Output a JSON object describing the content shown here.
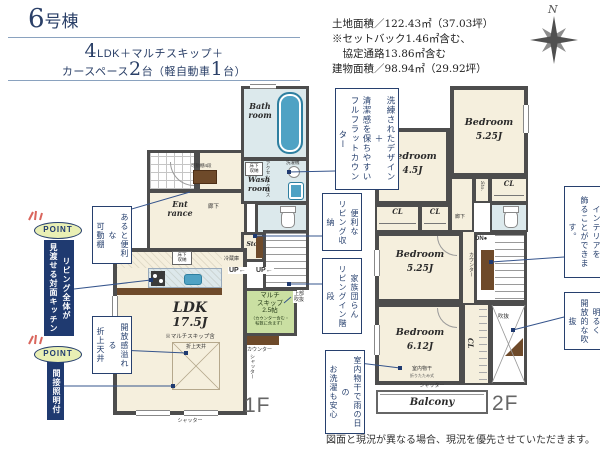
{
  "colors": {
    "navy": "#1f3a70",
    "annotation_navy": "#27406e",
    "leader_line": "#35548c",
    "room_cream": "#f5efdd",
    "water_blue": "#dce9ec",
    "fixture_teal": "#4fa2c4",
    "skip_green": "#cadfa2",
    "wood_brown": "#6e4a2a",
    "wall_gray": "#4d4d4d",
    "point_badge_bg": "#e9efb4",
    "tick_red": "#d9655c"
  },
  "header": {
    "building_num": "6",
    "building_name": "号棟",
    "spec_num1": "4",
    "spec_rest1": "LDK＋マルチスキップ＋",
    "spec_pre2": "カースペース",
    "spec_num2": "2",
    "spec_mid2": "台（軽自動車",
    "spec_num3": "1",
    "spec_end2": "台）"
  },
  "site_info": {
    "lines": [
      "土地面積／122.43㎡（37.03坪）",
      "※セットバック1.46㎡含む、",
      "　協定通路13.86㎡含む",
      "建物面積／98.94㎡（29.92坪）"
    ]
  },
  "compass": {
    "label": "N"
  },
  "points": [
    {
      "badge": "POINT",
      "text": "リビング全体が\n見渡せる対面キッチン"
    },
    {
      "badge": "POINT",
      "text": "間接照明付き"
    }
  ],
  "annotations": [
    {
      "text": "あると便利な\n可動棚"
    },
    {
      "text": "開放感溢れる\n折上天井"
    },
    {
      "text": "洗練されたデザイン＋\n清潔感を保ちやすい\nフルフラットカウンター"
    },
    {
      "text": "便利な\nリビング収納"
    },
    {
      "text": "家族団らん\nリビングイン階段"
    },
    {
      "text": "室内物干で雨の日の\nお洗濯も安心"
    },
    {
      "text": "インテリアを\n飾ることができます。"
    },
    {
      "text": "明るく\n開放的な吹抜"
    }
  ],
  "floor1": {
    "label": "1F",
    "bath": "Bath\nroom",
    "wash": "Wash\nroom",
    "entrance": "Ent\nrance",
    "ldk_name": "LDK",
    "ldk_size": "17.5J",
    "ldk_note": "※マルチスキップ含",
    "oriage": "折上天井",
    "multiskip": "マルチ\nスキップ\n2.5帖",
    "multiskip_note": "（カウンター含む・\n帖数に含まず）",
    "joubu_fukinuke": "上部\n吹抜",
    "rouka": "廊下",
    "kadoudana": "可動棚4段",
    "reizouko": "冷蔵庫",
    "yukashita": "床下\n収納",
    "accent_cloth": "アクセントクロス",
    "sentakuki": "洗濯機",
    "sto": "Sto.",
    "up1": "UP←",
    "up2": "UP←",
    "counter": "カウンター",
    "shutter_side": "シャッター",
    "shutter_bottom": "シャッター"
  },
  "floor2": {
    "label": "2F",
    "bed1_name": "Bedroom",
    "bed1_size": "4.5J",
    "bed2_name": "Bedroom",
    "bed2_size": "5.25J",
    "bed3_name": "Bedroom",
    "bed3_size": "5.25J",
    "bed4_name": "Bedroom",
    "bed4_size": "6.12J",
    "cl": "CL",
    "sto": "Sto.",
    "rouka": "廊下",
    "dn": "DN●",
    "counter": "カウンター",
    "fukinuke": "吹抜",
    "monohoshi": "室内物干",
    "monohoshi_note": "折りたたみ式",
    "shutter": "シャッター",
    "balcony": "Balcony"
  },
  "disclaimer": "図面と現況が異なる場合、現況を優先させていただきます。"
}
